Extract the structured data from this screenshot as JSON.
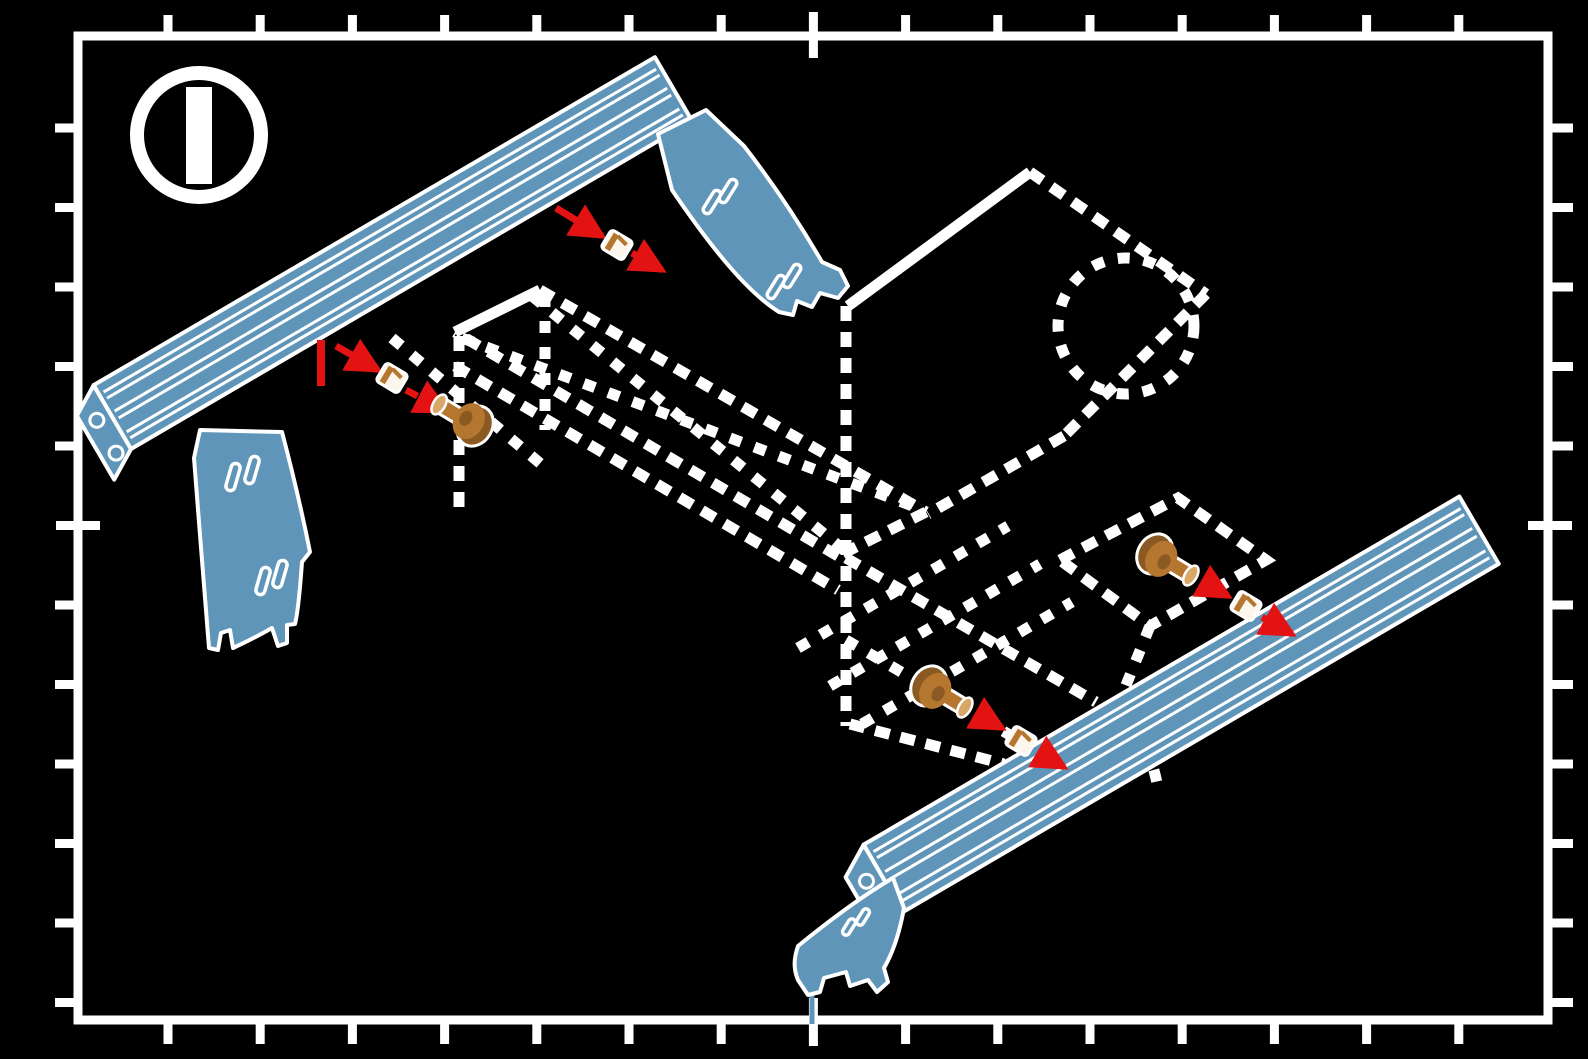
{
  "badge": {
    "icon": "step-number-icon",
    "value": "1"
  },
  "colors": {
    "background": "#000000",
    "line_white": "#FFFFFF",
    "extrusion_blue": "#5E95B9",
    "arrow_red": "#E41313",
    "screw_brown": "#B5762F",
    "screw_brown_dark": "#8A5A22",
    "screw_brown_light": "#D8A868"
  },
  "frame": {
    "border": {
      "x": 78,
      "y": 36,
      "width": 1470,
      "height": 984,
      "stroke_width": 9
    },
    "ticks": {
      "top": {
        "start": 168,
        "step": 92.2,
        "count": 15,
        "long_index": 7
      },
      "bottom": {
        "start": 168,
        "step": 92.2,
        "count": 15,
        "long_index": 7
      },
      "left": {
        "start": 128,
        "step": 79.5,
        "count": 12,
        "long_index": 5
      },
      "right": {
        "start": 128,
        "step": 79.5,
        "count": 12,
        "long_index": 5
      }
    }
  },
  "icons": [
    "step-number-icon",
    "screw-icon",
    "t-nut-icon",
    "insertion-arrow-icon",
    "slot-position-mark"
  ],
  "annotations": [
    {
      "id": "fastener-top",
      "mark": null,
      "segments": [
        {
          "x1": 556,
          "y1": 208,
          "x2": 602,
          "y2": 236,
          "dashed": false,
          "arrow": true
        },
        {
          "x1": 632,
          "y1": 253,
          "x2": 662,
          "y2": 270,
          "dashed": true,
          "arrow": true
        }
      ],
      "tnut": {
        "x": 617,
        "y": 245,
        "rot": 31
      },
      "screw": null
    },
    {
      "id": "fastener-left",
      "mark": {
        "x1": 321,
        "y1": 340,
        "x2": 321,
        "y2": 386
      },
      "segments": [
        {
          "x1": 336,
          "y1": 346,
          "x2": 378,
          "y2": 370,
          "dashed": false,
          "arrow": true
        },
        {
          "x1": 406,
          "y1": 390,
          "x2": 446,
          "y2": 411,
          "dashed": true,
          "arrow": true
        }
      ],
      "tnut": {
        "x": 392,
        "y": 378,
        "rot": 31
      },
      "screw": {
        "x": 470,
        "y": 423,
        "rot": 31
      }
    },
    {
      "id": "fastener-upper-right",
      "mark": null,
      "segments": [
        {
          "x1": 1184,
          "y1": 571,
          "x2": 1228,
          "y2": 596,
          "dashed": true,
          "arrow": true
        },
        {
          "x1": 1262,
          "y1": 617,
          "x2": 1292,
          "y2": 634,
          "dashed": true,
          "arrow": true
        }
      ],
      "tnut": {
        "x": 1246,
        "y": 606,
        "rot": 31
      },
      "screw": {
        "x": 1160,
        "y": 557,
        "rot": 211
      }
    },
    {
      "id": "fastener-bottom",
      "mark": null,
      "segments": [
        {
          "x1": 958,
          "y1": 703,
          "x2": 1002,
          "y2": 728,
          "dashed": true,
          "arrow": true
        },
        {
          "x1": 1038,
          "y1": 752,
          "x2": 1064,
          "y2": 767,
          "dashed": true,
          "arrow": true
        }
      ],
      "tnut": {
        "x": 1021,
        "y": 741,
        "rot": 31
      },
      "screw": {
        "x": 934,
        "y": 689,
        "rot": 211
      }
    }
  ]
}
